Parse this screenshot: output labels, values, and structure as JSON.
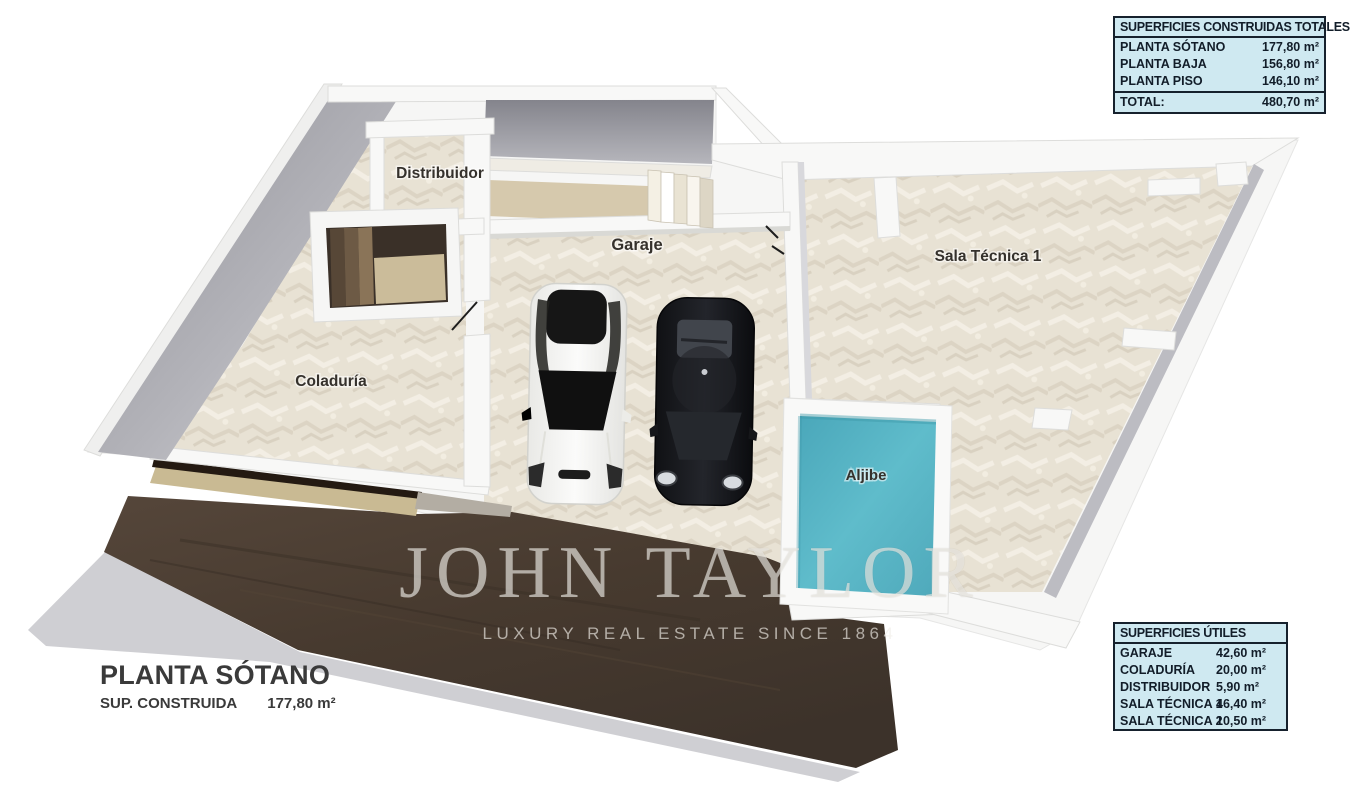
{
  "watermark": {
    "brand": "JOHN TAYLOR",
    "tagline": "LUXURY REAL ESTATE SINCE 1864"
  },
  "title_block": {
    "title": "PLANTA SÓTANO",
    "sup_label": "SUP. CONSTRUIDA",
    "sup_value": "177,80 m²"
  },
  "rooms": {
    "distribuidor": "Distribuidor",
    "garaje": "Garaje",
    "sala_tecnica_1": "Sala Técnica 1",
    "coladuria": "Coladuría",
    "aljibe": "Aljibe"
  },
  "tables": {
    "built": {
      "header": "SUPERFICIES CONSTRUIDAS TOTALES",
      "rows": [
        {
          "label": "PLANTA SÓTANO",
          "value": "177,80 m²"
        },
        {
          "label": "PLANTA BAJA",
          "value": "156,80 m²"
        },
        {
          "label": "PLANTA PISO",
          "value": "146,10 m²"
        }
      ],
      "total": {
        "label": "TOTAL:",
        "value": "480,70 m²"
      }
    },
    "useful": {
      "header": "SUPERFICIES ÚTILES",
      "rows": [
        {
          "label": "GARAJE",
          "value": "42,60 m²"
        },
        {
          "label": "COLADURÍA",
          "value": "20,00 m²"
        },
        {
          "label": "DISTRIBUIDOR",
          "value": "5,90 m²"
        },
        {
          "label": "SALA TÉCNICA 1",
          "value": "46,40 m²"
        },
        {
          "label": "SALA TÉCNICA 2",
          "value": "10,50 m²"
        }
      ]
    }
  },
  "colors": {
    "table_bg": "#cfe9f1",
    "table_border": "#16212d",
    "aljibe_teal": "#58b6c6",
    "terrain_brown": "#4a3d31",
    "floor_beige": "#e8e2d4",
    "wall_white": "#f8f8f7",
    "concrete_gray": "#9a9aa1"
  }
}
